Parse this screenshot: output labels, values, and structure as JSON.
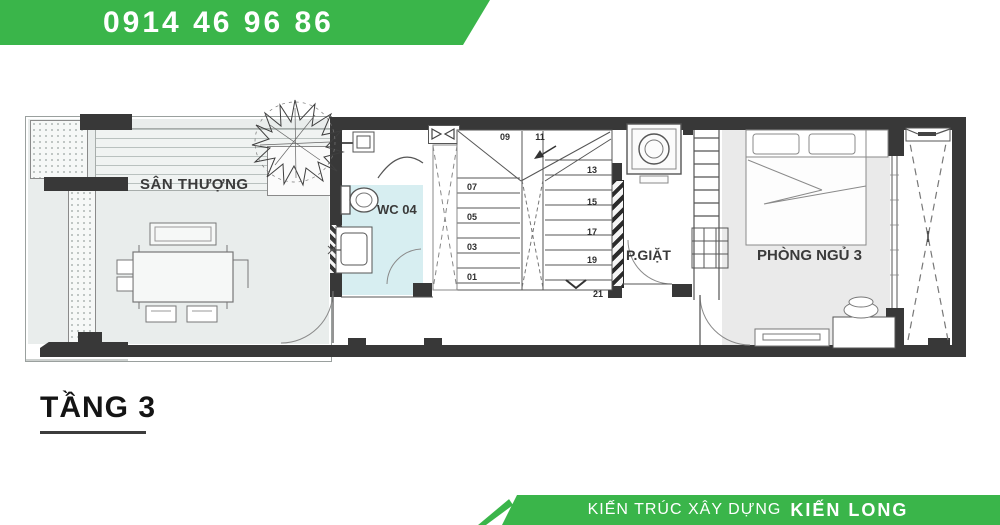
{
  "top_banner": {
    "phone": "0914 46 96 86",
    "color": "#3ab54a"
  },
  "bottom_banner": {
    "prefix": "KIẾN TRÚC XÂY DỰNG",
    "brand": "KIẾN LONG",
    "color": "#3ab54a"
  },
  "plan": {
    "floor_title": "TẦNG 3",
    "rooms": {
      "terrace_label": "SÂN THƯỢNG",
      "wc_label": "WC 04",
      "laundry_label": "P.GIẶT",
      "bedroom_label": "PHÒNG NGỦ 3"
    },
    "stair_numbers": {
      "left": [
        "07",
        "05",
        "03",
        "01"
      ],
      "landing": [
        "09",
        "11"
      ],
      "right": [
        "13",
        "15",
        "17",
        "19"
      ],
      "last": "21"
    },
    "colors": {
      "banner_green": "#3ab54a",
      "wall_dark": "#383838",
      "wc_floor": "#d7eef1",
      "terrace_floor": "#e9edec",
      "bedroom_floor": "#eaeaea"
    }
  }
}
